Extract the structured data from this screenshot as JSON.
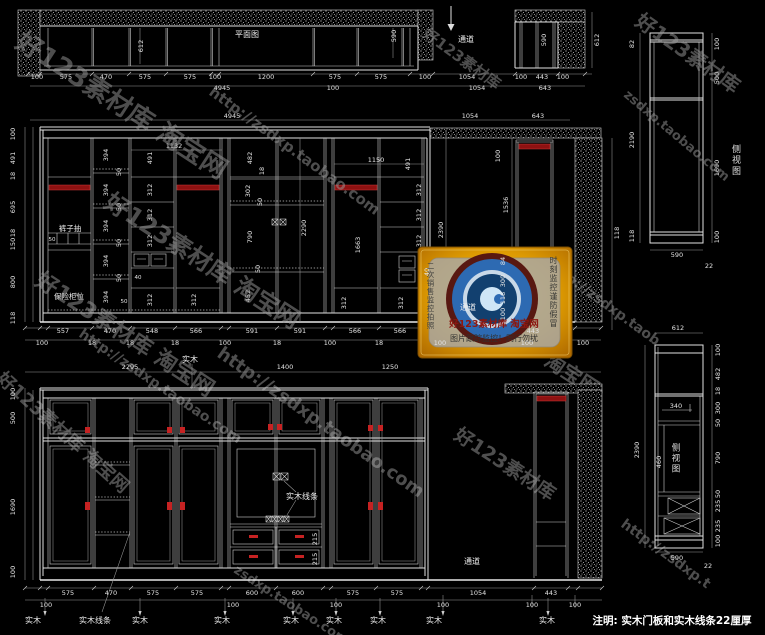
{
  "watermarks": [
    "好123素材库 淘宝网",
    "http://zsdxp.taobao.com",
    "好123素材库",
    "zsdxp.taobao.com",
    "好123素材库 淘宝网",
    "好123素材库 淘宝网",
    "http://zsdxp.taobao.com",
    "好123素材库 淘宝网",
    "http://zsdxp.taobao.com",
    "zsdxp.taobao.com",
    "http://zsdxp.taob",
    "http://zsdxp.t",
    "好123素材库",
    "淘宝网",
    "好123素材库"
  ],
  "plan": {
    "title": "平面图",
    "channel": "通道",
    "depth": "612",
    "depth_right": "590",
    "row1": [
      "100",
      "575",
      "470",
      "575",
      "575",
      "100",
      "1200",
      "575",
      "575",
      "100"
    ],
    "total": "4945",
    "extra": "100",
    "mini": {
      "depth": "590",
      "side": "612",
      "row1": [
        "1054",
        "100",
        "443",
        "100"
      ],
      "row2": [
        "1054",
        "643"
      ]
    }
  },
  "side_top": {
    "label": "侧视图",
    "left": [
      "82",
      "2190",
      "118"
    ],
    "right": [
      "100",
      "500",
      "1690",
      "100"
    ],
    "bottom": [
      "590",
      "22"
    ]
  },
  "mid": {
    "top": [
      "4945",
      "1054",
      "643"
    ],
    "left": [
      "100",
      "491",
      "18",
      "695",
      "18",
      "150",
      "800",
      "118"
    ],
    "b1": {
      "d50": "50",
      "trouser": "裤子抽",
      "safe": "保险柜位"
    },
    "b2": [
      "394",
      "50",
      "394",
      "50",
      "394",
      "50",
      "394",
      "50",
      "394"
    ],
    "b2x": "50",
    "b34": {
      "span": "1132",
      "h": "491",
      "col": [
        "312",
        "312",
        "312"
      ],
      "s40": "40",
      "bot": [
        "312",
        "312"
      ]
    },
    "b56": {
      "d": [
        "482",
        "18",
        "302",
        "50",
        "790",
        "50",
        "452"
      ],
      "total": "2290"
    },
    "b78": {
      "span": "1150",
      "h": "491",
      "hang": "1663",
      "col": [
        "312",
        "312",
        "312"
      ],
      "bot": [
        "312",
        "312"
      ]
    },
    "right": {
      "top": "100",
      "open": "1536",
      "total": "2390",
      "chan": "通道",
      "shelf": [
        "84",
        "300",
        "118",
        "100"
      ],
      "wall": "118",
      "s40": "40",
      "d443": "443",
      "c": [
        "100",
        "100",
        "100"
      ]
    },
    "row1": [
      "557",
      "470",
      "548",
      "566",
      "591",
      "591",
      "566",
      "566"
    ],
    "row2": [
      "100",
      "18",
      "18",
      "18",
      "100",
      "18",
      "100",
      "18"
    ]
  },
  "logo": {
    "line1": "好123素材库 淘宝网",
    "line2": "图片跟踪监控！同行勿扰",
    "vleft": "二次销售监控拍照",
    "vright": "时刻监控谨防假冒"
  },
  "be": {
    "top": [
      "2295",
      "1400",
      "1250"
    ],
    "sw": "实木",
    "left": [
      "100",
      "500",
      "1690",
      "100"
    ],
    "trim": "实木线条",
    "d215": [
      "215",
      "215"
    ],
    "chan": "通道",
    "row1": [
      "575",
      "470",
      "575",
      "575",
      "600",
      "600",
      "575",
      "575",
      "1054",
      "443"
    ],
    "row2": [
      "100",
      "100",
      "100",
      "100",
      "100",
      "100"
    ],
    "labels": [
      "实木",
      "实木线条",
      "实木",
      "实木",
      "实木",
      "实木",
      "实木",
      "实木",
      "实木"
    ]
  },
  "sb": {
    "label": "侧视图",
    "top": "612",
    "total": "2390",
    "right": [
      "100",
      "482",
      "18",
      "300",
      "50",
      "790",
      "50",
      "235",
      "235",
      "100"
    ],
    "i340": "340",
    "i460": "460",
    "bottom": [
      "590",
      "22"
    ]
  },
  "note": "注明: 实木门板和实木线条22厘厚"
}
